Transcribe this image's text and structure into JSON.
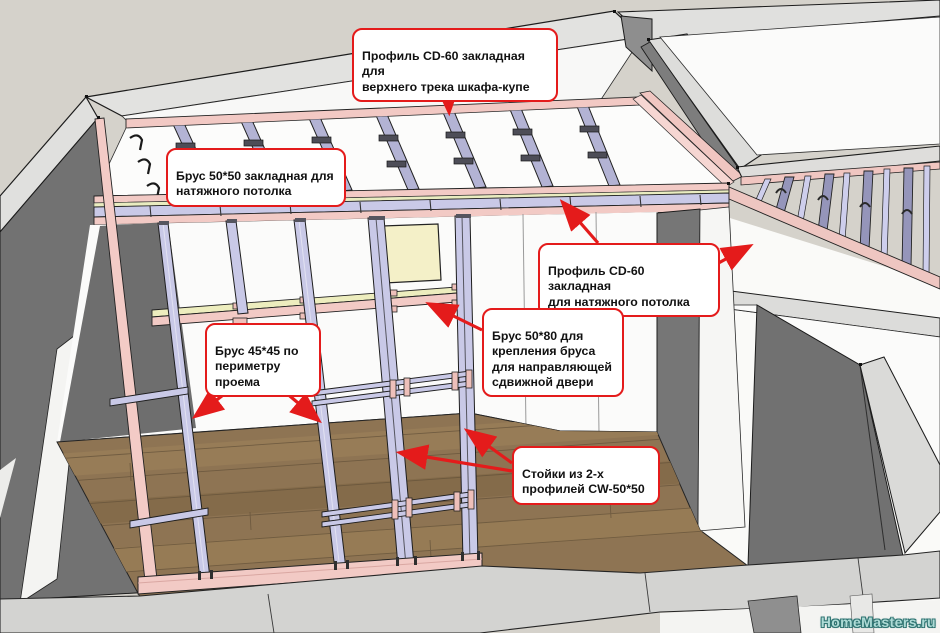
{
  "annotations": {
    "labels": [
      {
        "id": "cd60-top-track",
        "text": "Профиль CD-60 закладная для\nверхнего трека шкафа-купе"
      },
      {
        "id": "brus-50x50",
        "text": "Брус 50*50 закладная для\nнатяжного потолка"
      },
      {
        "id": "cd60-ceiling",
        "text": "Профиль CD-60 закладная\nдля натяжного потолка"
      },
      {
        "id": "brus-50x80",
        "text": "Брус 50*80 для\nкрепления бруса\nдля направляющей\nсдвижной двери"
      },
      {
        "id": "brus-45x45",
        "text": "Брус 45*45 по\nпериметру\nпроема"
      },
      {
        "id": "cw-stands",
        "text": "Стойки из 2-х\nпрофилей CW-50*50"
      }
    ]
  },
  "watermark": {
    "text": "HomeMasters.ru"
  },
  "palette": {
    "background": "#d5d2cb",
    "callout_border": "#e41b1b",
    "arrow_red": "#e41b1b",
    "wall_top": "#dfdfdd",
    "wall_dark_face": "#727272",
    "white_surface": "#fbfbfa",
    "pink_brus": "#f2c9c4",
    "lavender_profile": "#c9c9e7",
    "ceiling_profile": "#b3b3d4",
    "yellow_brus": "#ededbe",
    "yellow_panel": "#f4f0c8",
    "wood_floor": "#8e7453",
    "floor_slab": "#d3d3d1",
    "watermark_color": "#aedbd6"
  }
}
